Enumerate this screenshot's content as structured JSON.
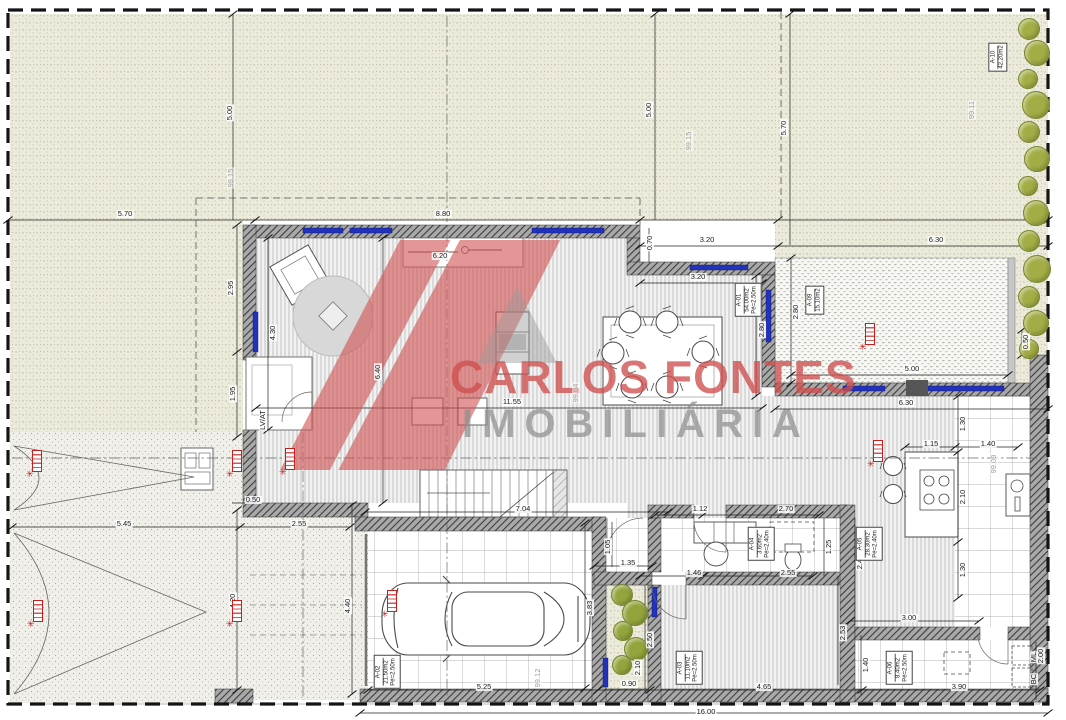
{
  "watermark": {
    "brand": "CARLOS FONTES",
    "subtitle": "IMOBILIÁRIA"
  },
  "colors": {
    "dimension_text": "#1a1a1a",
    "elevation_text": "#9c9c9c",
    "marker_red": "#c42020",
    "tree_green": "#a3ad45",
    "window_blue": "#2233bb",
    "watermark_red": "#cf4f4f",
    "watermark_gray": "#8d8d8d"
  },
  "dimensions": [
    {
      "t": "5.00",
      "x": 230,
      "y": 113,
      "r": 1
    },
    {
      "t": "5.00",
      "x": 649,
      "y": 110,
      "r": 1
    },
    {
      "t": "5.70",
      "x": 784,
      "y": 128,
      "r": 1
    },
    {
      "t": "99.15",
      "x": 689,
      "y": 141,
      "r": 1,
      "e": 1
    },
    {
      "t": "99.15",
      "x": 231,
      "y": 178,
      "r": 1,
      "e": 1
    },
    {
      "t": "99.11",
      "x": 972,
      "y": 110,
      "r": 1,
      "e": 1
    },
    {
      "t": "5.70",
      "x": 125,
      "y": 214
    },
    {
      "t": "8.80",
      "x": 443,
      "y": 214
    },
    {
      "t": "3.20",
      "x": 707,
      "y": 240
    },
    {
      "t": "6.30",
      "x": 936,
      "y": 240
    },
    {
      "t": "6.20",
      "x": 440,
      "y": 256
    },
    {
      "t": "0.70",
      "x": 650,
      "y": 243,
      "r": 1
    },
    {
      "t": "3.20",
      "x": 698,
      "y": 277
    },
    {
      "t": "2.80",
      "x": 762,
      "y": 330,
      "r": 1
    },
    {
      "t": "2.80",
      "x": 796,
      "y": 312,
      "r": 1
    },
    {
      "t": "0.50",
      "x": 1026,
      "y": 342,
      "r": 1
    },
    {
      "t": "2.95",
      "x": 231,
      "y": 288,
      "r": 1
    },
    {
      "t": "4.30",
      "x": 273,
      "y": 333,
      "r": 1
    },
    {
      "t": "1.95",
      "x": 233,
      "y": 394,
      "r": 1
    },
    {
      "t": "6.40",
      "x": 378,
      "y": 372,
      "r": 1
    },
    {
      "t": "11.55",
      "x": 512,
      "y": 402
    },
    {
      "t": "99.04",
      "x": 576,
      "y": 393,
      "r": 1,
      "e": 1
    },
    {
      "t": "5.00",
      "x": 912,
      "y": 369
    },
    {
      "t": "6.30",
      "x": 906,
      "y": 403
    },
    {
      "t": "1.30",
      "x": 963,
      "y": 424,
      "r": 1
    },
    {
      "t": "1.15",
      "x": 931,
      "y": 444
    },
    {
      "t": "1.40",
      "x": 988,
      "y": 444
    },
    {
      "t": "99.09",
      "x": 994,
      "y": 464,
      "r": 1,
      "e": 1
    },
    {
      "t": "2.10",
      "x": 963,
      "y": 497,
      "r": 1
    },
    {
      "t": "1.30",
      "x": 963,
      "y": 570,
      "r": 1
    },
    {
      "t": "2.40",
      "x": 860,
      "y": 562,
      "r": 1
    },
    {
      "t": "3.00",
      "x": 909,
      "y": 618
    },
    {
      "t": "1.40",
      "x": 866,
      "y": 665,
      "r": 1
    },
    {
      "t": "3.90",
      "x": 959,
      "y": 687
    },
    {
      "t": "2.00",
      "x": 1041,
      "y": 656,
      "r": 1
    },
    {
      "t": "ML",
      "x": 1034,
      "y": 657,
      "r": 1
    },
    {
      "t": "BC",
      "x": 1034,
      "y": 679,
      "r": 1
    },
    {
      "t": "1.12",
      "x": 700,
      "y": 509
    },
    {
      "t": "2.70",
      "x": 786,
      "y": 509
    },
    {
      "t": "1.25",
      "x": 829,
      "y": 547,
      "r": 1
    },
    {
      "t": "1.05",
      "x": 608,
      "y": 547,
      "r": 1
    },
    {
      "t": "1.35",
      "x": 628,
      "y": 563
    },
    {
      "t": "1.46",
      "x": 694,
      "y": 573
    },
    {
      "t": "2.55",
      "x": 788,
      "y": 573
    },
    {
      "t": "2.50",
      "x": 650,
      "y": 640,
      "r": 1
    },
    {
      "t": "2.10",
      "x": 638,
      "y": 668,
      "r": 1
    },
    {
      "t": "0.90",
      "x": 629,
      "y": 684
    },
    {
      "t": "4.65",
      "x": 764,
      "y": 687
    },
    {
      "t": "2.53",
      "x": 843,
      "y": 633,
      "r": 1
    },
    {
      "t": "16.00",
      "x": 706,
      "y": 712
    },
    {
      "t": "7.04",
      "x": 523,
      "y": 509
    },
    {
      "t": "3.83",
      "x": 590,
      "y": 608,
      "r": 1
    },
    {
      "t": "4.40",
      "x": 348,
      "y": 606,
      "r": 1
    },
    {
      "t": "4.20",
      "x": 233,
      "y": 601,
      "r": 1
    },
    {
      "t": "5.25",
      "x": 484,
      "y": 687
    },
    {
      "t": "99.12",
      "x": 538,
      "y": 678,
      "r": 1,
      "e": 1
    },
    {
      "t": "5.45",
      "x": 124,
      "y": 524
    },
    {
      "t": "2.55",
      "x": 299,
      "y": 524
    },
    {
      "t": "0.50",
      "x": 253,
      "y": 500
    },
    {
      "t": "LV/AT",
      "x": 263,
      "y": 420,
      "r": 1
    }
  ],
  "area_labels": [
    {
      "lines": [
        "A-10",
        "42.20m2"
      ],
      "x": 998,
      "y": 57
    },
    {
      "lines": [
        "A-09",
        "15.10m2"
      ],
      "x": 815,
      "y": 300
    },
    {
      "lines": [
        "A-01",
        "54.00m2",
        "Pé=2.50m"
      ],
      "x": 748,
      "y": 300
    },
    {
      "lines": [
        "A-04",
        "3.60m2",
        "Pé=2.40m"
      ],
      "x": 761,
      "y": 544
    },
    {
      "lines": [
        "A-03",
        "11.10m2",
        "Pé=2.50m"
      ],
      "x": 689,
      "y": 668
    },
    {
      "lines": [
        "A-02",
        "21.50m2",
        "Pé=2.50m"
      ],
      "x": 387,
      "y": 672
    },
    {
      "lines": [
        "A-05",
        "28.30m2",
        "Pé=2.40m"
      ],
      "x": 869,
      "y": 544
    },
    {
      "lines": [
        "A-06",
        "8.40m2",
        "Pé=2.50m"
      ],
      "x": 899,
      "y": 668
    }
  ],
  "markers": [
    {
      "x": 37,
      "y": 472
    },
    {
      "x": 237,
      "y": 472
    },
    {
      "x": 38,
      "y": 622
    },
    {
      "x": 237,
      "y": 622
    },
    {
      "x": 290,
      "y": 470
    },
    {
      "x": 392,
      "y": 612
    },
    {
      "x": 870,
      "y": 345
    },
    {
      "x": 878,
      "y": 462
    }
  ],
  "trees": [
    {
      "x": 1028,
      "y": 28,
      "r": 10
    },
    {
      "x": 1036,
      "y": 52,
      "r": 12
    },
    {
      "x": 1027,
      "y": 78,
      "r": 9
    },
    {
      "x": 1035,
      "y": 104,
      "r": 13
    },
    {
      "x": 1028,
      "y": 131,
      "r": 10
    },
    {
      "x": 1036,
      "y": 158,
      "r": 12
    },
    {
      "x": 1027,
      "y": 185,
      "r": 9
    },
    {
      "x": 1035,
      "y": 212,
      "r": 12
    },
    {
      "x": 1028,
      "y": 240,
      "r": 10
    },
    {
      "x": 1036,
      "y": 268,
      "r": 13
    },
    {
      "x": 1028,
      "y": 296,
      "r": 10
    },
    {
      "x": 1035,
      "y": 322,
      "r": 12
    },
    {
      "x": 1028,
      "y": 348,
      "r": 9
    }
  ],
  "plants": [
    {
      "x": 621,
      "y": 594,
      "r": 10
    },
    {
      "x": 634,
      "y": 612,
      "r": 12
    },
    {
      "x": 622,
      "y": 630,
      "r": 9
    },
    {
      "x": 635,
      "y": 648,
      "r": 11
    },
    {
      "x": 621,
      "y": 664,
      "r": 9
    }
  ]
}
